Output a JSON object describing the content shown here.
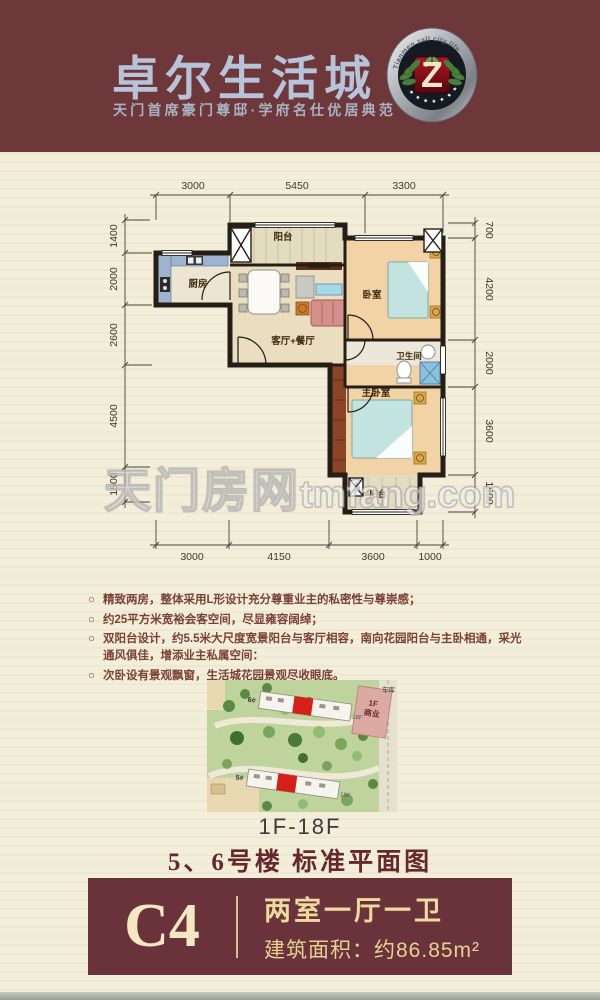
{
  "header": {
    "title": "卓尔生活城",
    "subtitle": "天门首席豪门尊邸·学府名仕优居典范",
    "logo": {
      "ring_text": "Tianmen zall city life",
      "letter": "Z",
      "stars": "★ ★ ★ ★ ★ ★ ★"
    }
  },
  "colors": {
    "header_bg": "#6e373a",
    "brand_title": "#b7c3d8",
    "card_bg": "#6a333b",
    "gold_text": "#eeda9f",
    "page_bg": "#f2eed9",
    "wall": "#241e17",
    "highlight_unit_red": "#d42018"
  },
  "floorplan": {
    "dims_top": [
      "3000",
      "5450",
      "3300"
    ],
    "dims_bottom": [
      "3000",
      "4150",
      "3600",
      "1000"
    ],
    "dims_left": [
      "1400",
      "2000",
      "2600",
      "4500",
      "1500"
    ],
    "dims_right": [
      "700",
      "4200",
      "2000",
      "3600",
      "1500"
    ],
    "rooms": {
      "balcony_top": "阳台",
      "kitchen": "厨房",
      "living": "客厅+餐厅",
      "bedroom": "卧室",
      "bathroom": "卫生间",
      "master_bedroom": "主卧室",
      "balcony_bottom": "阳台"
    },
    "watermark_cn": "天门房网",
    "watermark_en": "tmfang.com"
  },
  "features": {
    "marker": "○",
    "items": [
      "精致两房，整体采用L形设计充分尊重业主的私密性与尊崇感；",
      "约25平方米宽裕会客空间，尽显雍容阔绰；",
      "双阳台设计，约5.5米大尺度宽景阳台与客厅相容，南向花园阳台与主卧相通，采光通风俱佳，增添业主私属空间：",
      "次卧设有景观飘窗，生活城花园景观尽收眼底。"
    ]
  },
  "siteplan": {
    "floors_label": "1F-18F",
    "labels": {
      "building_top": "6#",
      "building_bottom": "5#",
      "commercial_line1": "1F",
      "commercial_line2": "商业",
      "garage": "车库",
      "top_floor": "18F"
    }
  },
  "plan_title": "5、6号楼 标准平面图",
  "unit_card": {
    "code": "C4",
    "layout": "两室一厅一卫",
    "area": "建筑面积：约86.85m²"
  }
}
